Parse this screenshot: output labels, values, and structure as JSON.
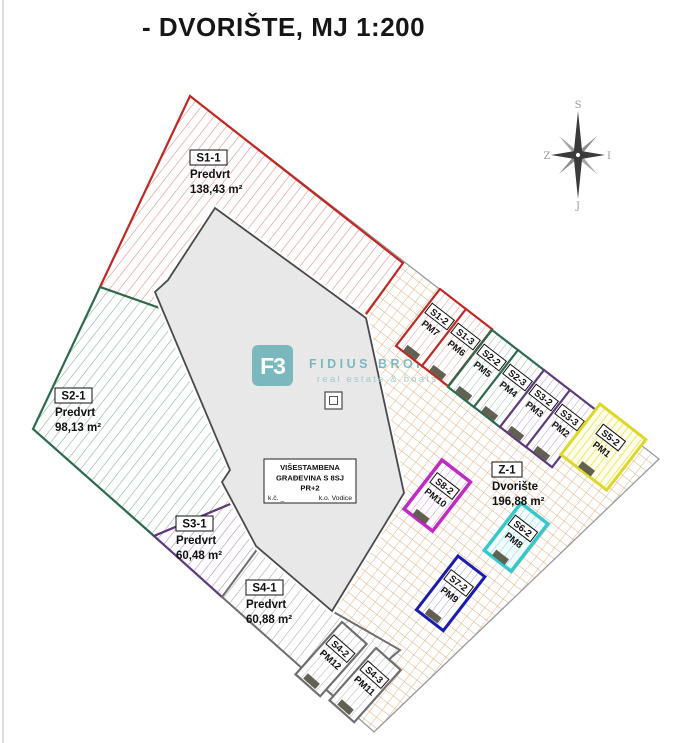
{
  "title": "- DVORIŠTE, MJ 1:200",
  "compass": {
    "north": "S",
    "west": "Z",
    "east": "I",
    "south": "J"
  },
  "watermark": {
    "logo": "F3",
    "name": "FIDIUS BROKER",
    "tagline": "real estate & boats"
  },
  "building_label": {
    "line1": "VIŠESTAMBENA",
    "line2": "GRAĐEVINA S 8SJ",
    "line3": "PR+2",
    "line4_left": "k.č. _",
    "line4_right": "k.o. Vodice"
  },
  "areas": {
    "gardens": [
      {
        "id": "S1-1",
        "type": "Predvrt",
        "area": "138,43 m²",
        "color": "#c22722"
      },
      {
        "id": "S2-1",
        "type": "Predvrt",
        "area": "98,13 m²",
        "color": "#2c6b4e"
      },
      {
        "id": "S3-1",
        "type": "Predvrt",
        "area": "60,48 m²",
        "color": "#5e3a80"
      },
      {
        "id": "S4-1",
        "type": "Predvrt",
        "area": "60,88 m²",
        "color": "#6f6f6f"
      }
    ],
    "courtyard": {
      "id": "Z-1",
      "type": "Dvorište",
      "area": "196,88 m²",
      "color": "#c8955f"
    },
    "parking": [
      {
        "id": "S1-2",
        "pm": "PM7",
        "color": "#c22722"
      },
      {
        "id": "S1-3",
        "pm": "PM6",
        "color": "#c22722"
      },
      {
        "id": "S2-2",
        "pm": "PM5",
        "color": "#2c6b4e"
      },
      {
        "id": "S2-3",
        "pm": "PM4",
        "color": "#2c6b4e"
      },
      {
        "id": "S3-2",
        "pm": "PM3",
        "color": "#5e3a80"
      },
      {
        "id": "S3-3",
        "pm": "PM2",
        "color": "#5e3a80"
      },
      {
        "id": "S5-2",
        "pm": "PM1",
        "color": "#ddd82b"
      },
      {
        "id": "S8-2",
        "pm": "PM10",
        "color": "#c02bc4"
      },
      {
        "id": "S6-2",
        "pm": "PM8",
        "color": "#35c8cc"
      },
      {
        "id": "S7-2",
        "pm": "PM9",
        "color": "#1c1cae"
      },
      {
        "id": "S4-2",
        "pm": "PM12",
        "color": "#6f6f6f"
      },
      {
        "id": "S4-3",
        "pm": "PM11",
        "color": "#6f6f6f"
      }
    ]
  }
}
